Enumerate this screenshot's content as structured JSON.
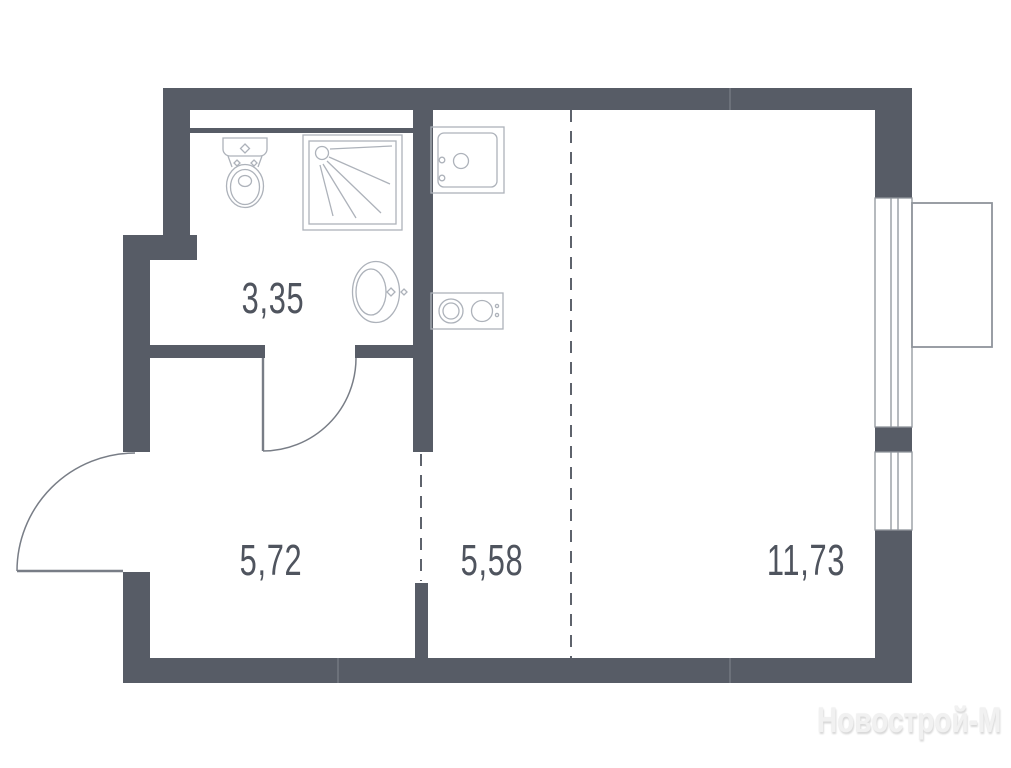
{
  "plan": {
    "rooms": [
      {
        "id": "bathroom",
        "area_label": "3,35"
      },
      {
        "id": "hallway",
        "area_label": "5,72"
      },
      {
        "id": "kitchen-zone",
        "area_label": "5,58"
      },
      {
        "id": "living-zone",
        "area_label": "11,73"
      }
    ],
    "fixtures": [
      "toilet-icon",
      "shower-icon",
      "washbasin-icon",
      "kitchen-sink-icon",
      "stove-icon"
    ],
    "watermark": "Новострой-М",
    "colors": {
      "wall": "#575C66",
      "fixture": "#ADB2BA",
      "window_frame": "#8F949B",
      "door": "#787D86",
      "dashed": "#5E636C",
      "label": "#4F545E",
      "watermark": "#F1F1F1",
      "background": "#FFFFFF"
    }
  }
}
